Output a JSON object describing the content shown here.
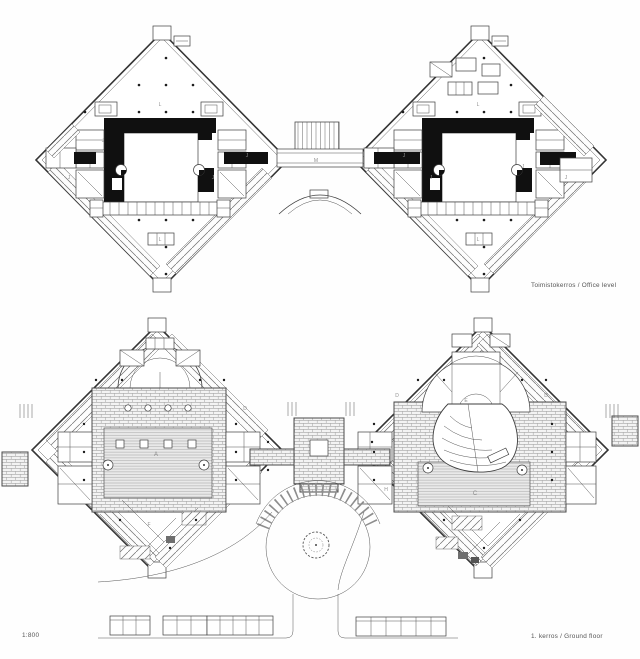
{
  "sheet_title": "Floor plan drawing",
  "captions": {
    "office_level": "Toimistokerros / Office level",
    "ground_floor": "1. kerros / Ground floor",
    "scale": "1:800"
  },
  "plans": {
    "office": {
      "name": "Office level plan",
      "labels": [
        {
          "char": "L"
        },
        {
          "char": "L"
        },
        {
          "char": "L"
        },
        {
          "char": "L"
        },
        {
          "char": "M"
        },
        {
          "char": "J"
        },
        {
          "char": "J"
        },
        {
          "char": "J"
        },
        {
          "char": "J"
        },
        {
          "char": "J"
        },
        {
          "char": "J"
        },
        {
          "char": "J"
        },
        {
          "char": "J"
        }
      ]
    },
    "ground": {
      "name": "Ground floor plan",
      "labels": [
        {
          "char": "A"
        },
        {
          "char": "C"
        },
        {
          "char": "D"
        },
        {
          "char": "D"
        },
        {
          "char": "D"
        },
        {
          "char": "E"
        },
        {
          "char": "F"
        },
        {
          "char": "H"
        }
      ]
    }
  },
  "colors": {
    "paper": "#fefefe",
    "ink": "#3e3e3e",
    "poche": "#101010",
    "hatch_gray": "#8d8d8d",
    "floor_gray": "#e9e9e9"
  }
}
